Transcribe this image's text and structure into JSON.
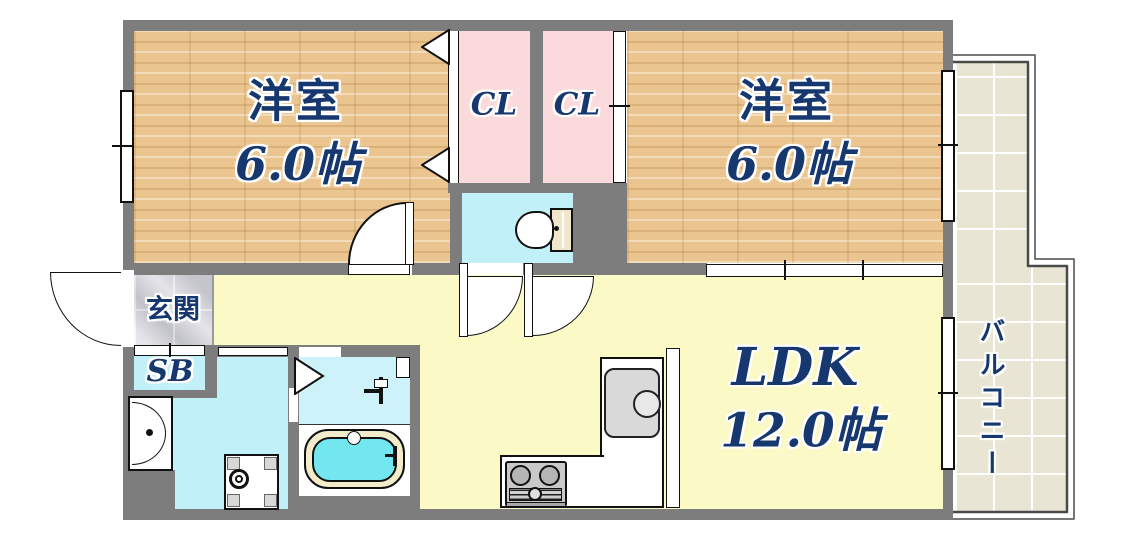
{
  "rooms": {
    "bedroom1": {
      "name": "洋室",
      "size": "6.0帖"
    },
    "bedroom2": {
      "name": "洋室",
      "size": "6.0帖"
    },
    "closet1": {
      "label": "CL"
    },
    "closet2": {
      "label": "CL"
    },
    "entrance": {
      "label": "玄関"
    },
    "shoebox": {
      "label": "SB"
    },
    "ldk": {
      "name": "LDK",
      "size": "12.0帖"
    },
    "balcony": {
      "label": "バルコニー"
    }
  },
  "colors": {
    "wall_gray": "#7d7d7d",
    "wood_floor_tan": "#ebc58f",
    "closet_pink": "#fbdadc",
    "wet_area_cyan": "#c2f0f8",
    "living_yellow": "#fbf9c6",
    "balcony_beige": "#e9e5d4",
    "entrance_marble_gray": "#d3d3da",
    "bathtub_water_cyan": "#72e7f0",
    "bathtub_rim_cream": "#f2ecca",
    "label_navy": "#16386e"
  }
}
